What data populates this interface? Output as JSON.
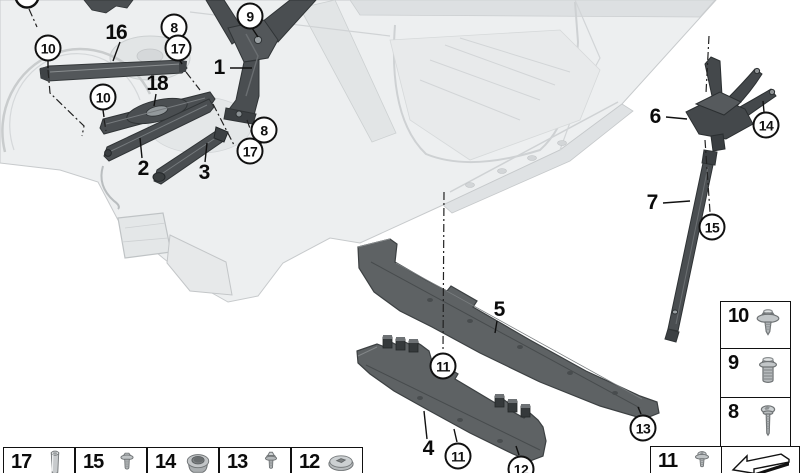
{
  "colors": {
    "background": "#ffffff",
    "outline": "#111111",
    "part_dark_gray": "#4a4e51",
    "panel_gray": "#5e6264",
    "body_shell_light": "#edeff0",
    "fastener_gray": "#bfc3c5"
  },
  "part_labels": [
    {
      "text": "16",
      "x": 116,
      "y": 33
    },
    {
      "text": "1",
      "x": 219,
      "y": 68
    },
    {
      "text": "18",
      "x": 157,
      "y": 84
    },
    {
      "text": "2",
      "x": 143,
      "y": 169
    },
    {
      "text": "3",
      "x": 204,
      "y": 173
    },
    {
      "text": "5",
      "x": 499,
      "y": 310
    },
    {
      "text": "4",
      "x": 428,
      "y": 449
    },
    {
      "text": "6",
      "x": 655,
      "y": 117
    },
    {
      "text": "7",
      "x": 652,
      "y": 203
    }
  ],
  "callouts": [
    {
      "text": "10",
      "x": 48,
      "y": 48
    },
    {
      "text": "8",
      "x": 174,
      "y": 27
    },
    {
      "text": "17",
      "x": 178,
      "y": 48
    },
    {
      "text": "9",
      "x": 250,
      "y": 16
    },
    {
      "text": "10",
      "x": 103,
      "y": 97
    },
    {
      "text": "8",
      "x": 264,
      "y": 130
    },
    {
      "text": "17",
      "x": 250,
      "y": 151
    },
    {
      "text": "14",
      "x": 766,
      "y": 125
    },
    {
      "text": "15",
      "x": 712,
      "y": 227
    },
    {
      "text": "11",
      "x": 443,
      "y": 366
    },
    {
      "text": "11",
      "x": 458,
      "y": 456
    },
    {
      "text": "13",
      "x": 643,
      "y": 428
    },
    {
      "text": "12",
      "x": 521,
      "y": 469
    }
  ],
  "legend": {
    "bottom_row": [
      {
        "number": "17",
        "icon": "spacer-sleeve-icon"
      },
      {
        "number": "15",
        "icon": "flange-bolt-icon"
      },
      {
        "number": "14",
        "icon": "rivet-nut-icon"
      },
      {
        "number": "13",
        "icon": "hex-screw-icon"
      },
      {
        "number": "12",
        "icon": "cap-nut-icon"
      }
    ],
    "right_column": [
      {
        "number": "10",
        "icon": "flange-screw-icon"
      },
      {
        "number": "9",
        "icon": "hex-bolt-icon"
      },
      {
        "number": "8",
        "icon": "pan-head-screw-icon"
      }
    ],
    "corner": [
      {
        "number": "11",
        "icon": "torx-flange-screw-icon"
      }
    ],
    "direction_indicator_icon": "direction-arrow-icon"
  }
}
